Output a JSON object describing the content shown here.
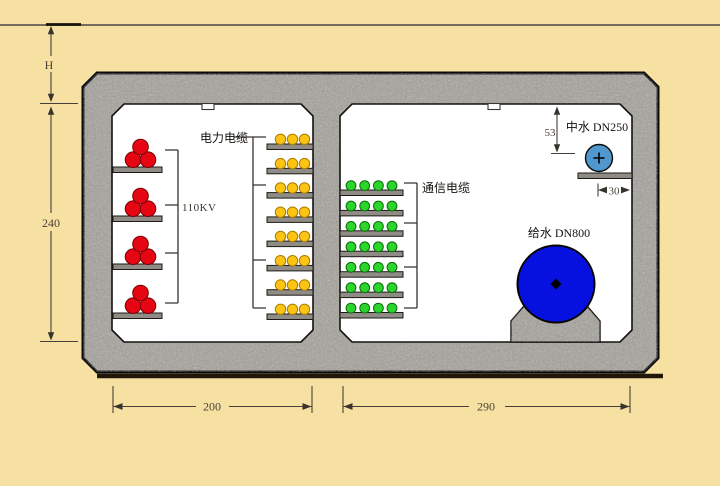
{
  "diagram": {
    "type": "utility-tunnel-cross-section",
    "ground": {
      "depth_label": "H"
    },
    "dimensions": {
      "interior_height": "240",
      "left_chamber_width": "200",
      "right_chamber_width": "290",
      "pipe_top_clearance": "53",
      "bracket_offset": "30"
    },
    "left_chamber": {
      "hv_label": "110KV",
      "power_cable_label": "电力电缆",
      "hv_groups": 4,
      "hv_cables_per_group": 3,
      "power_racks": 8,
      "power_cables_per_rack": 3
    },
    "right_chamber": {
      "comm_cable_label": "通信电缆",
      "comm_racks": 7,
      "comm_cables_per_rack": 4,
      "reclaimed_water_label": "中水 DN250",
      "water_supply_label": "给水 DN800"
    },
    "colors": {
      "background": "#f6e0a2",
      "concrete": "#a3a099",
      "chamber": "#ffffff",
      "outline": "#0a0a0a",
      "tray": "#8f8b85",
      "hv_cable": "#e60613",
      "hv_cable_edge": "#7a0005",
      "power_cable": "#fdc413",
      "power_cable_edge": "#a97c00",
      "comm_cable": "#2bd52b",
      "comm_cable_edge": "#0b6b0b",
      "reclaimed_pipe": "#4f97cd",
      "supply_pipe": "#0611e0",
      "dimension": "#45413a"
    }
  }
}
